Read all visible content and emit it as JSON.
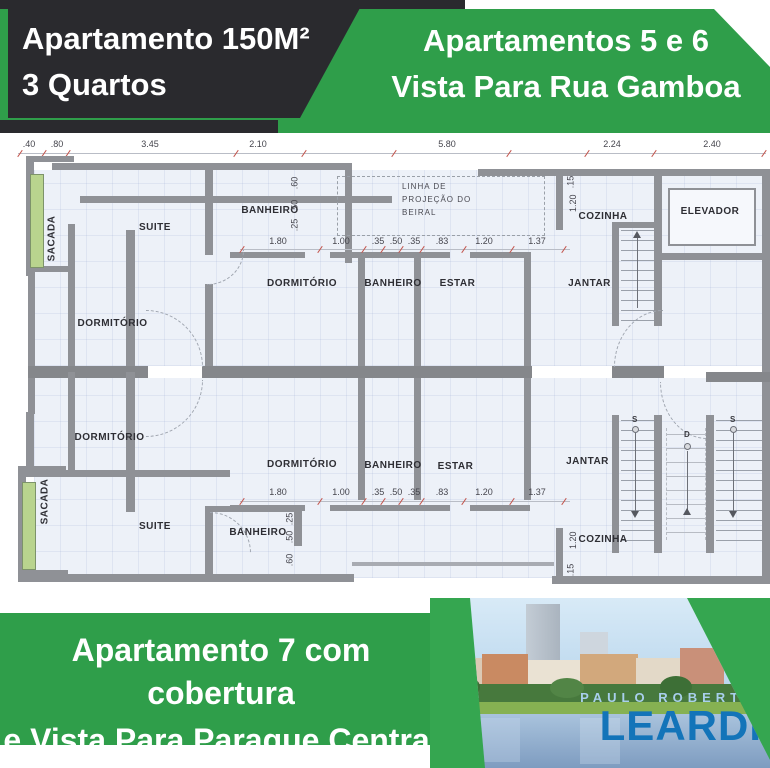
{
  "colors": {
    "green": "#2f9e4a",
    "green2": "#35a650",
    "dark": "#2a2a2e",
    "wall": "#8f9196",
    "sacada": "#b9d48e",
    "brandlight": "#a8cfec",
    "brandblue": "#1374b9"
  },
  "banner_top_left": {
    "line1": "Apartamento 150M²",
    "line2": "3 Quartos"
  },
  "banner_top_right": {
    "line1": "Apartamentos 5 e 6",
    "line2": "Vista Para Rua Gamboa"
  },
  "banner_bottom": {
    "line1": "Apartamento 7 com cobertura",
    "line2": "e Vista Para Paraque Central"
  },
  "brand": {
    "top": "PAULO ROBERTO",
    "name": "LEARDI"
  },
  "floorplan": {
    "top_dims": [
      ".40",
      ".80",
      "3.45",
      "2.10",
      "5.80",
      "2.24",
      "2.40"
    ],
    "mid_dims_upper": [
      "1.80",
      "1.00",
      ".35",
      ".50",
      ".35",
      ".83",
      "1.20",
      "1.37"
    ],
    "mid_dims_lower": [
      "1.80",
      "1.00",
      ".35",
      ".50",
      ".35",
      ".83",
      "1.20",
      "1.37"
    ],
    "vchain_upper": [
      ".60",
      ".50",
      ".25"
    ],
    "vchain_lower": [
      ".25",
      ".50",
      ".60"
    ],
    "cozinha_chain_upper": [
      ".15",
      "1.20"
    ],
    "cozinha_chain_lower": [
      "1.20",
      ".15"
    ],
    "beiral": [
      "LINHA DE",
      "PROJEÇÃO DO",
      "BEIRAL"
    ],
    "rooms": {
      "sacada": "SACADA",
      "suite": "SUITE",
      "banheiro": "BANHEIRO",
      "dormitorio": "DORMITÓRIO",
      "estar": "ESTAR",
      "jantar": "JANTAR",
      "cozinha": "COZINHA",
      "elevador": "ELEVADOR"
    },
    "stairs": {
      "s": "S",
      "d": "D"
    }
  }
}
